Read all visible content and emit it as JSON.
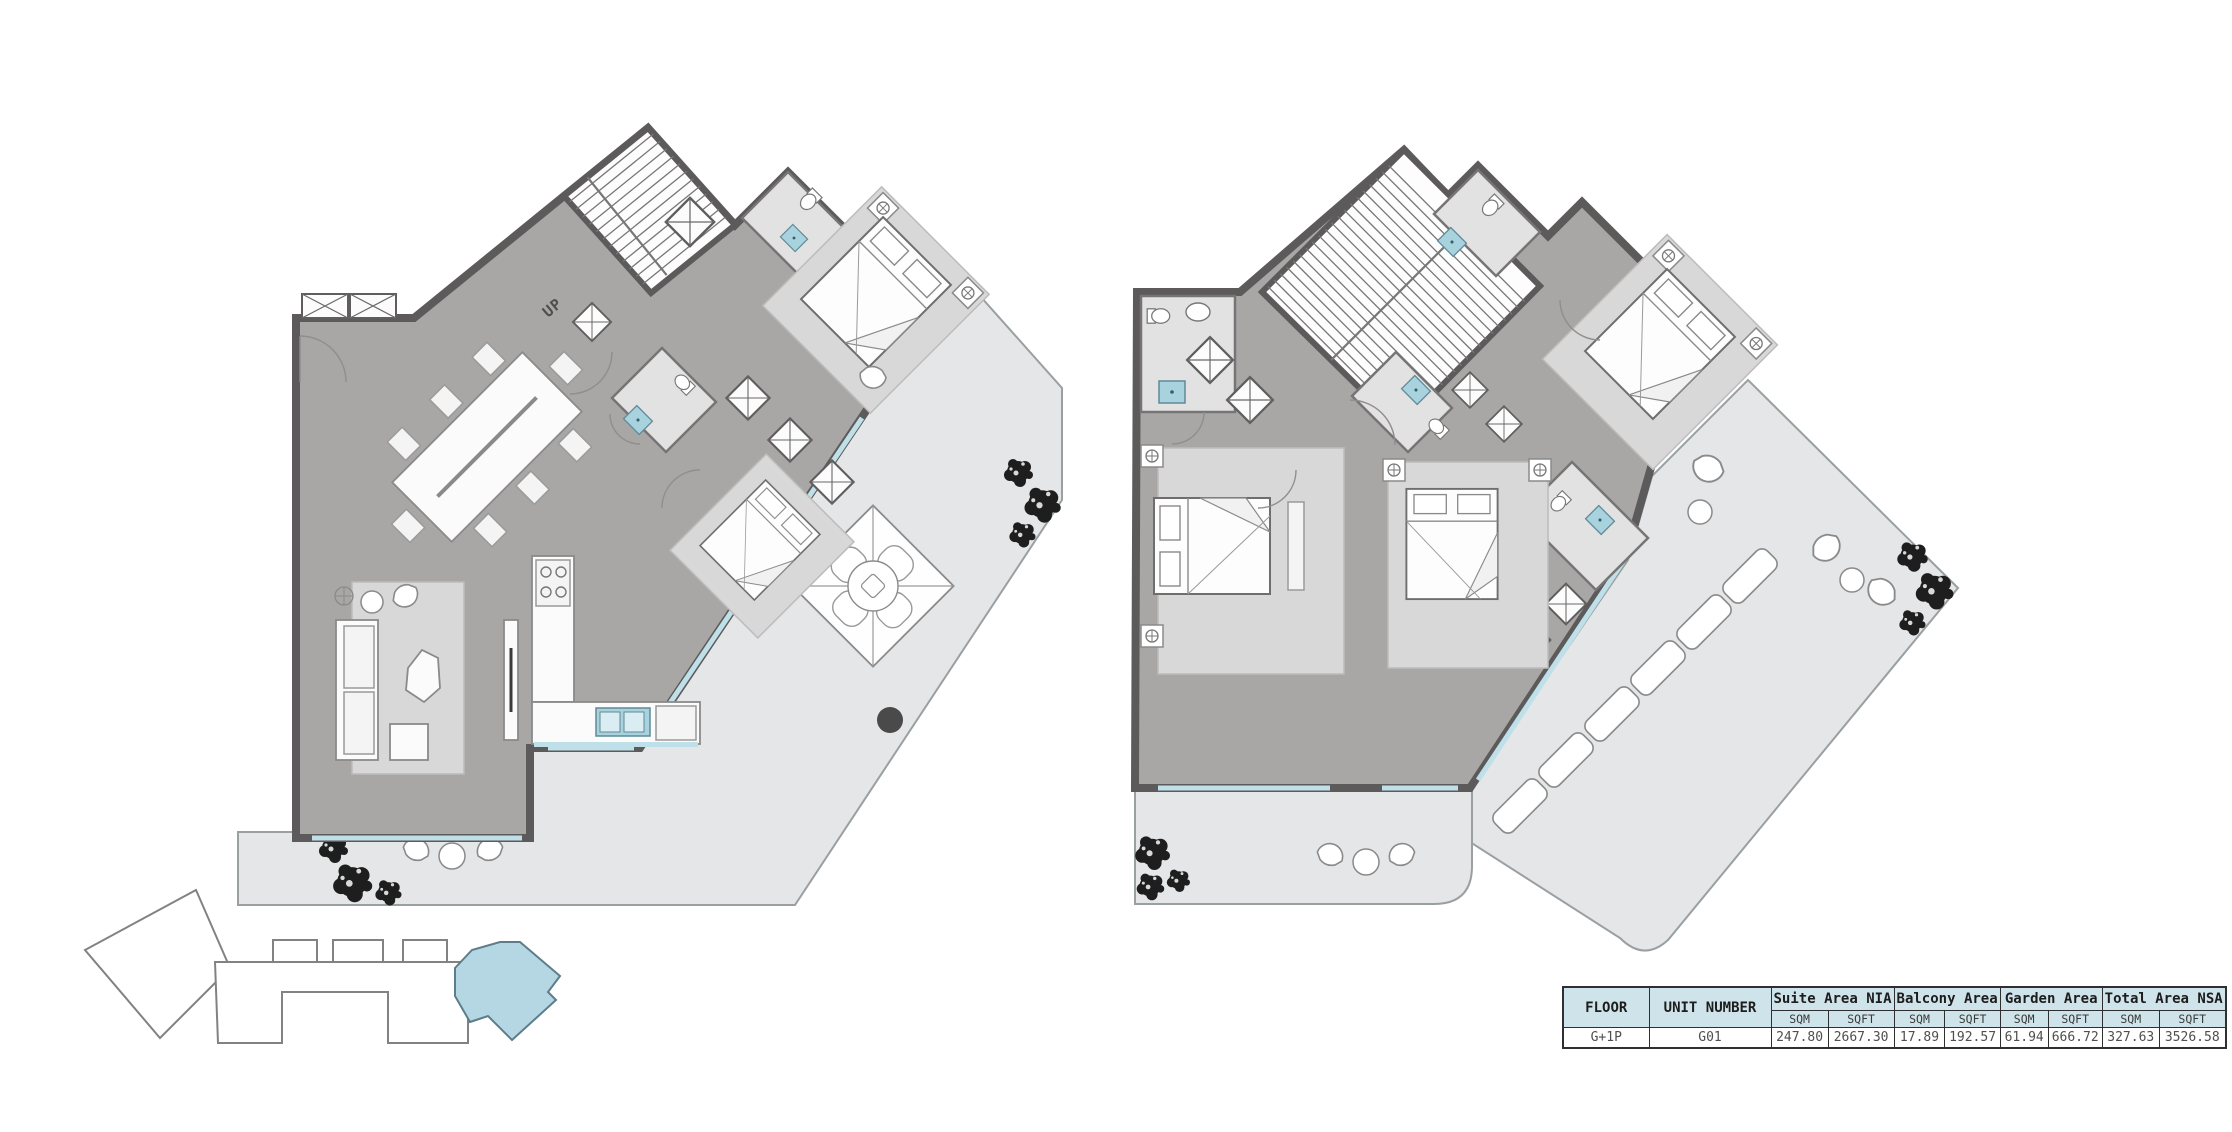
{
  "left_plan": {
    "name": "lower-level-floor-plan",
    "stair_label": "UP"
  },
  "right_plan": {
    "name": "upper-level-floor-plan",
    "stair_label": "DN"
  },
  "key_plan": {
    "highlighted_unit": "G01"
  },
  "colors": {
    "wall": "#5c5a5a",
    "floor": "#a9a6a6",
    "room": "#d8d8d8",
    "terrace": "#e4e6e7",
    "window": "#bfe0e8",
    "fixture": "#a8d3de",
    "table-header": "#cfe4ea",
    "keyplan-highlight": "#b5d7e4",
    "tree": "#1e1e1e"
  },
  "area_table": {
    "header": {
      "floor": "FLOOR",
      "unit_number": "UNIT NUMBER",
      "groups": [
        {
          "label": "Suite Area NIA"
        },
        {
          "label": "Balcony Area"
        },
        {
          "label": "Garden Area"
        },
        {
          "label": "Total Area NSA"
        }
      ],
      "unit_sqm": "SQM",
      "unit_sqft": "SQFT"
    },
    "rows": [
      {
        "floor": "G+1P",
        "unit_number": "G01",
        "values": [
          "247.80",
          "2667.30",
          "17.89",
          "192.57",
          "61.94",
          "666.72",
          "327.63",
          "3526.58"
        ]
      }
    ]
  }
}
